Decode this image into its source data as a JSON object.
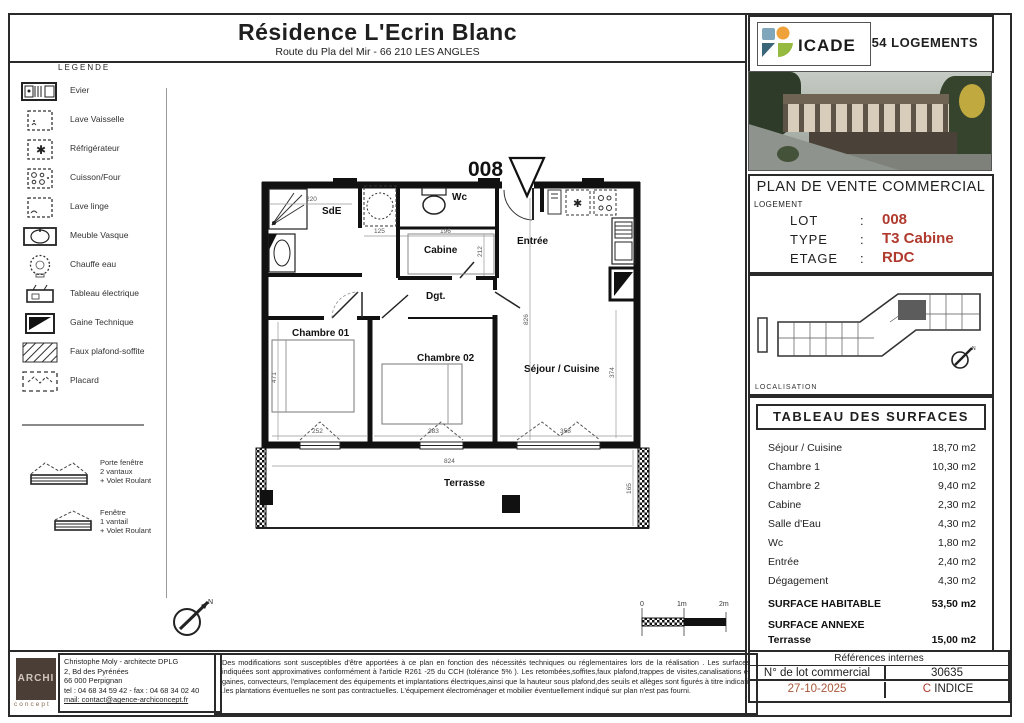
{
  "page": {
    "sheet_title": "Résidence L'Ecrin Blanc",
    "sheet_subtitle": "Route du Pla del Mir - 66 210 LES ANGLES"
  },
  "legend": {
    "heading": "LEGENDE",
    "items": [
      {
        "icon": "evier-icon",
        "label": "Evier"
      },
      {
        "icon": "lave-vaisselle-icon",
        "label": "Lave Vaisselle"
      },
      {
        "icon": "refrigerateur-icon",
        "label": "Réfrigérateur"
      },
      {
        "icon": "cuisson-four-icon",
        "label": "Cuisson/Four"
      },
      {
        "icon": "lave-linge-icon",
        "label": "Lave linge"
      },
      {
        "icon": "meuble-vasque-icon",
        "label": "Meuble Vasque"
      },
      {
        "icon": "chauffe-eau-icon",
        "label": "Chauffe eau"
      },
      {
        "icon": "tableau-electrique-icon",
        "label": "Tableau électrique"
      },
      {
        "icon": "gaine-technique-icon",
        "label": "Gaine Technique"
      },
      {
        "icon": "faux-plafond-icon",
        "label": "Faux plafond-soffite"
      },
      {
        "icon": "placard-icon",
        "label": "Placard"
      }
    ],
    "windows": [
      {
        "icon": "porte-fenetre-icon",
        "lines": [
          "Porte fenêtre",
          "2 vantaux",
          "+ Volet Roulant"
        ]
      },
      {
        "icon": "fenetre-icon",
        "lines": [
          "Fenêtre",
          "1 vantail",
          "+ Volet Roulant"
        ]
      }
    ]
  },
  "plan": {
    "lot_marker": "008",
    "rooms": {
      "sde": "SdE",
      "wc": "Wc",
      "cabine": "Cabine",
      "entree": "Entrée",
      "dgt": "Dgt.",
      "chambre1": "Chambre 01",
      "chambre2": "Chambre 02",
      "sejour": "Séjour / Cuisine",
      "terrasse": "Terrasse"
    },
    "dims": {
      "sde_w": "220",
      "closet_w": "125",
      "cabine_w": "196",
      "cabine_h": "212",
      "ch1_h": "471",
      "ch1_w": "252",
      "ch2_w": "383",
      "sejour_w": "358",
      "terrasse_w": "824",
      "terrasse_d": "165",
      "sejour_h": "374",
      "entree_h": "826"
    },
    "scalebar": {
      "zero": "0",
      "mid": "1m",
      "end": "2m"
    }
  },
  "panel": {
    "brand": "ICADE",
    "units_count": "54 LOGEMENTS",
    "doc_title": "PLAN DE VENTE COMMERCIAL",
    "logement": {
      "heading": "LOGEMENT",
      "rows": [
        {
          "label": "LOT",
          "sep": ":",
          "value": "008"
        },
        {
          "label": "TYPE",
          "sep": ":",
          "value": "T3 Cabine"
        },
        {
          "label": "ETAGE",
          "sep": ":",
          "value": "RDC"
        }
      ]
    },
    "localisation_label": "LOCALISATION",
    "surfaces": {
      "heading": "TABLEAU DES SURFACES",
      "rows": [
        {
          "label": "Séjour / Cuisine",
          "value": "18,70 m2"
        },
        {
          "label": "Chambre 1",
          "value": "10,30 m2"
        },
        {
          "label": "Chambre 2",
          "value": "9,40 m2"
        },
        {
          "label": "Cabine",
          "value": "2,30 m2"
        },
        {
          "label": "Salle d'Eau",
          "value": "4,30 m2"
        },
        {
          "label": "Wc",
          "value": "1,80 m2"
        },
        {
          "label": "Entrée",
          "value": "2,40 m2"
        },
        {
          "label": "Dégagement",
          "value": "4,30 m2"
        }
      ],
      "habitable": {
        "label": "SURFACE HABITABLE",
        "value": "53,50 m2"
      },
      "annexe_heading": "SURFACE ANNEXE",
      "annexe": {
        "label": "Terrasse",
        "value": "15,00 m2"
      }
    }
  },
  "footer": {
    "archi_logo": {
      "line1": "ARCHI",
      "line2": "concept"
    },
    "architect_lines": [
      "Christophe Moly - architecte DPLG",
      "2, Bd des Pyrénées",
      "66 000 Perpignan",
      "tel : 04 68 34 59 42 - fax : 04 68 34 02 40",
      "mail: contact@agence-archiconcept.fr"
    ],
    "disclaimer": "Des modifications sont susceptibles  d'être apportées à ce plan en fonction des nécessités techniques ou réglementaires lors de la réalisation . Les surfaces indiquées sont approximatives conformément à l'article R261 -25 du CCH (tolérance 5% ). Les retombées,soffites,faux plafond,trappes de visites,canalisations et gaines, convecteurs, l'emplacement des équipements et implantations électriques,ainsi que la hauteur sous plafond,des seuils et allèges sont figurés à titre indicatif .les plantations éventuelles ne sont pas contractuelles. L'équipement électroménager et mobilier éventuellement indiqué sur plan n'est pas fourni.",
    "references": {
      "heading": "Références internes",
      "lot_label": "N° de lot commercial",
      "lot_value": "30635",
      "date": "27-10-2025",
      "indice_letter": "C",
      "indice_word": "INDICE"
    }
  },
  "colors": {
    "accent_red": "#b03a2e",
    "date_red": "#a9573b",
    "line": "#2a2a2a"
  }
}
